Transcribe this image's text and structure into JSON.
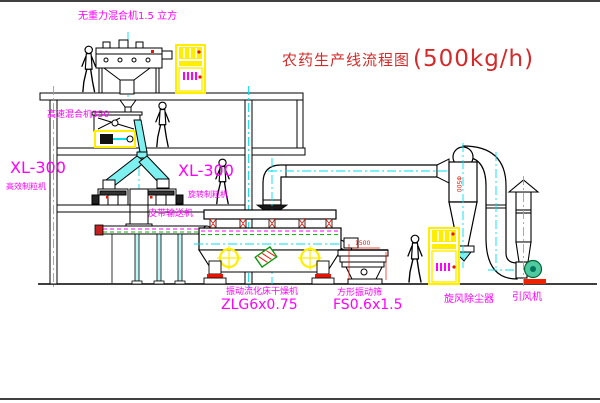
{
  "title": {
    "text": "农药生产线流程图",
    "capacity": "(500kg/h)"
  },
  "equipment_labels": {
    "gravity_mixer": "无重力混合机1.5 立方",
    "high_speed_mixer": "高速混合机350",
    "granulator_left_model": "XL-300",
    "granulator_left_name": "高效制粒机",
    "granulator_right_model": "XL-300",
    "granulator_right_name": "旋转制粒机",
    "belt_conveyor": "皮带输送机",
    "fluid_bed_dryer_name": "振动流化床干燥机",
    "fluid_bed_dryer_model": "ZLG6x0.75",
    "vibrating_sieve_name": "方形振动筛",
    "vibrating_sieve_model": "FS0.6x1.5",
    "cyclone_dust_collector": "旋风除尘器",
    "induced_draft_fan": "引风机"
  },
  "dimensions": {
    "sieve_length": "1500",
    "cyclone_diameter": "Φ500"
  },
  "colors": {
    "label_magenta": "#ff00ff",
    "title_red": "#d42a2a",
    "centerline_cyan": "#00e0ee",
    "highlight_yellow": "#ffee00",
    "accent_green": "#00bb00",
    "accent_red": "#ee1100"
  }
}
